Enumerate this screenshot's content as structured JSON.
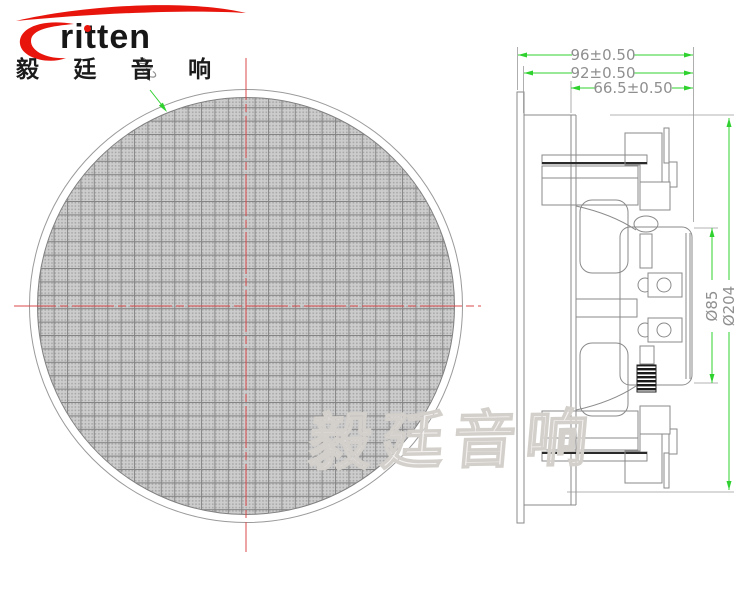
{
  "logo": {
    "brand": "ritten",
    "brand_cn": "毅 廷 音 响"
  },
  "watermark": {
    "text": "毅廷音响"
  },
  "front_view": {
    "grille_dim_label": "232"
  },
  "side_view": {
    "dim_overall_width": "96±0.50",
    "dim_body_width": "92±0.50",
    "dim_front_depth": "66.5±0.50",
    "dim_magnet_diameter": "Ø85",
    "dim_outer_diameter": "Ø204"
  },
  "colors": {
    "dimension_green": "#2fd12f",
    "dimension_text_gray": "#8f8f8f",
    "centerline_red": "#d84848",
    "drawing_line_gray": "#8a8a8a",
    "logo_red": "#e8150d",
    "watermark_gray": "#d3cfca",
    "mesh_fill": "#cdcdcd"
  }
}
